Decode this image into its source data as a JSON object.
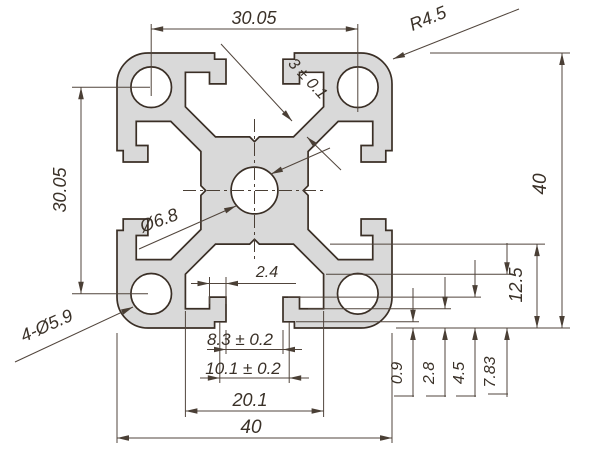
{
  "drawing": {
    "title": "aluminum-extrusion-profile-cross-section",
    "type": "technical-dimension-drawing",
    "units": "mm",
    "colors": {
      "background": "#ffffff",
      "profile_fill": "#d9d9d9",
      "outline": "#3a2f26",
      "dimension_lines": "#51453c",
      "text": "#3a3128"
    },
    "labels": {
      "top_hole_spacing": "30.05",
      "left_hole_spacing": "30.05",
      "corner_radius": "R4.5",
      "web_thickness": "3 ± 0.1",
      "overall_height": "40",
      "overall_width": "40",
      "slot_depth": "12.5",
      "center_bore": "Ø6.8",
      "corner_bores": "4-Ø5.9",
      "hook_width": "2.4",
      "slot_opening": "8.3 ± 0.2",
      "slot_throat": "10.1 ± 0.2",
      "cavity_width": "20.1",
      "lip_step_depth": "0.9",
      "lip_thickness": "2.8",
      "hook_depth": "4.5",
      "cavity_corner_depth": "7.83"
    }
  }
}
